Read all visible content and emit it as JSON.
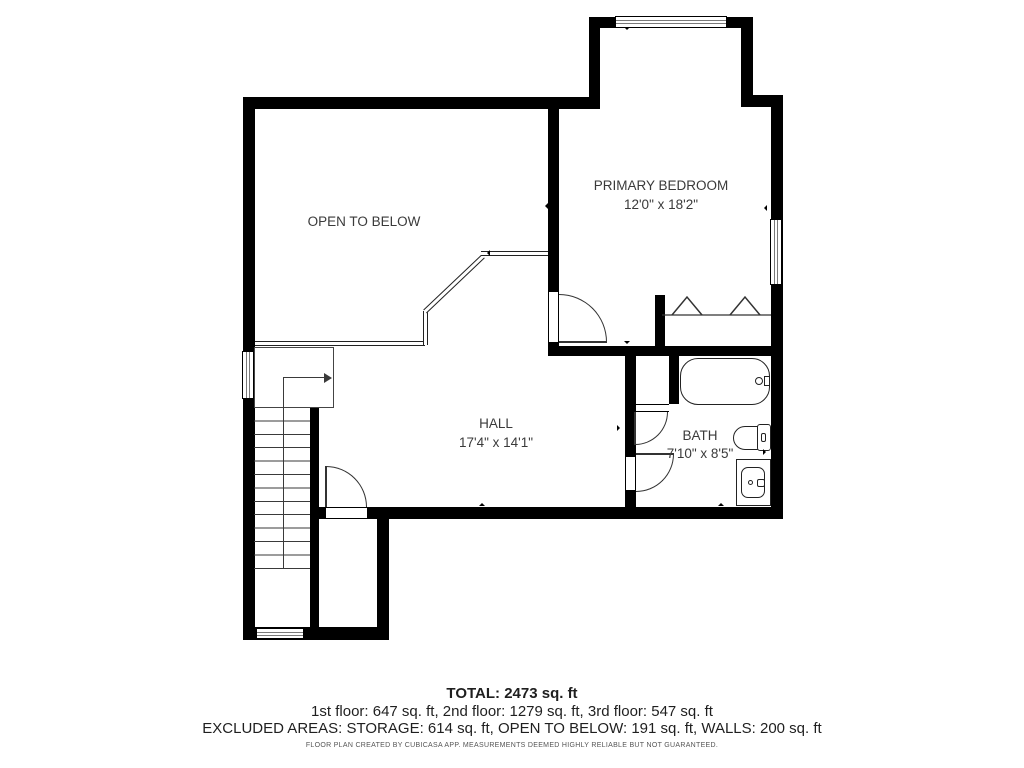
{
  "plan": {
    "open_to_below": {
      "label": "OPEN TO BELOW"
    },
    "primary_bedroom": {
      "label": "PRIMARY BEDROOM",
      "dims": "12'0\" x 18'2\""
    },
    "hall": {
      "label": "HALL",
      "dims": "17'4\" x 14'1\""
    },
    "bath": {
      "label": "BATH",
      "dims": "7'10\" x 8'5\""
    }
  },
  "summary": {
    "total": "TOTAL: 2473 sq. ft",
    "floors": "1st floor: 647 sq. ft, 2nd floor: 1279 sq. ft, 3rd floor: 547 sq. ft",
    "excluded": "EXCLUDED AREAS: STORAGE: 614 sq. ft, OPEN TO BELOW: 191 sq. ft, WALLS: 200 sq. ft",
    "disclaimer": "FLOOR PLAN CREATED BY CUBICASA APP. MEASUREMENTS DEEMED HIGHLY RELIABLE BUT NOT GUARANTEED."
  },
  "colors": {
    "wall": "#000000",
    "text": "#3a3a3a",
    "background": "#ffffff"
  }
}
